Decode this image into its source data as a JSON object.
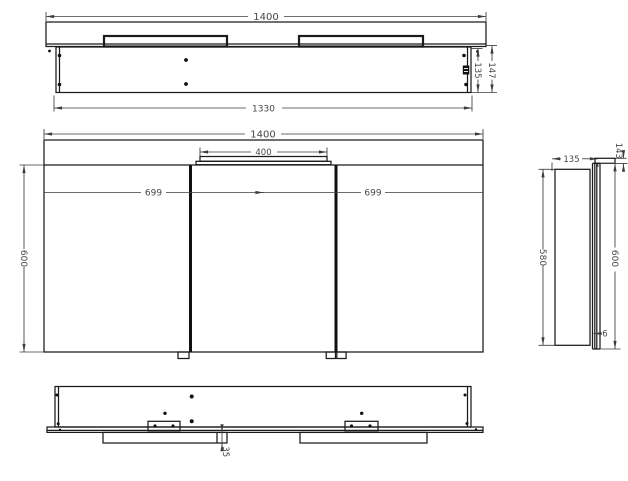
{
  "drawing": {
    "colors": {
      "background": "#ffffff",
      "line": "#1b1b1b",
      "dimension": "#474747"
    },
    "views": {
      "top": {
        "overall_width": "1400",
        "carcass_width": "1330",
        "carcass_depth": "135",
        "total_depth": "147"
      },
      "front": {
        "overall_width": "1400",
        "light_width": "400",
        "left_door_width": "699",
        "right_door_width": "699",
        "door_height": "600"
      },
      "side": {
        "depth": "135",
        "top_depth": "143",
        "carcass_height": "580",
        "door_height": "600",
        "door_thickness": "6"
      },
      "bottom": {
        "bracket_depth": "35"
      }
    }
  }
}
